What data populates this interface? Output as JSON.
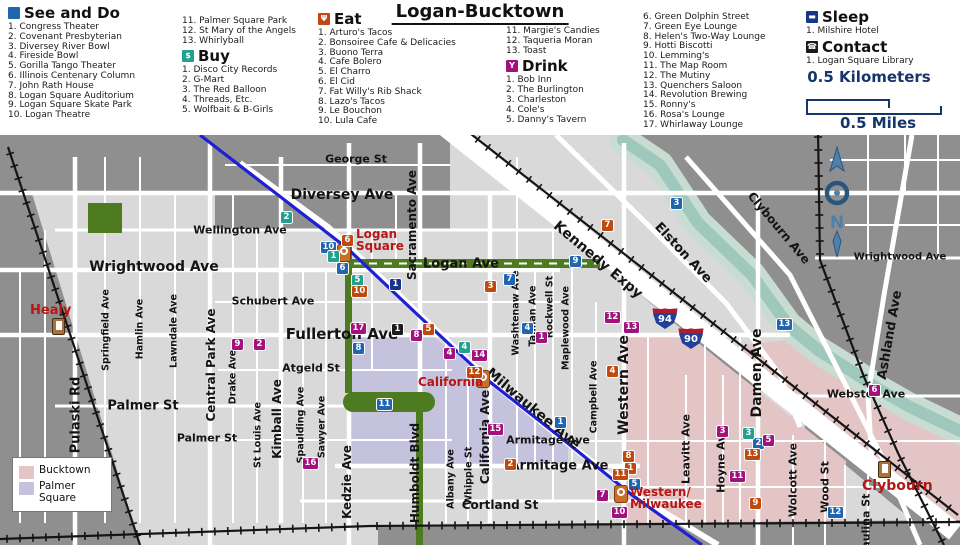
{
  "title": "Logan-Bucktown",
  "categories": {
    "see_do": {
      "label": "See and Do",
      "color": "#2065b1",
      "glyph": "",
      "items": [
        "Congress Theater",
        "Covenant Presbyterian",
        "Diversey River Bowl",
        "Fireside Bowl",
        "Gorilla Tango Theater",
        "Illinois Centenary Column",
        "John Rath House",
        "Logan Square Auditorium",
        "Logan Square Skate Park",
        "Logan Theatre",
        "Palmer Square Park",
        "St Mary of the Angels",
        "Whirlyball"
      ]
    },
    "buy": {
      "label": "Buy",
      "color": "#23a18e",
      "glyph": "$",
      "items": [
        "Disco City Records",
        "G-Mart",
        "The Red Balloon",
        "Threads, Etc.",
        "Wolfbait & B-Girls"
      ]
    },
    "eat": {
      "label": "Eat",
      "color": "#bf4a10",
      "glyph": "Ψ",
      "items": [
        "Arturo's Tacos",
        "Bonsoiree Cafe & Delicacies",
        "Buono Terra",
        "Cafe Bolero",
        "El Charro",
        "El Cid",
        "Fat Willy's Rib Shack",
        "Lazo's Tacos",
        "Le Bouchon",
        "Lula Cafe",
        "Margie's Candies",
        "Taqueria Moran",
        "Toast"
      ]
    },
    "drink": {
      "label": "Drink",
      "color": "#a2117e",
      "glyph": "Y",
      "items": [
        "Bob Inn",
        "The Burlington",
        "Charleston",
        "Cole's",
        "Danny's Tavern",
        "Green Dolphin Street",
        "Green Eye Lounge",
        "Helen's Two-Way Lounge",
        "Hotti Biscotti",
        "Lemming's",
        "The Map Room",
        "The Mutiny",
        "Quenchers Saloon",
        "Revolution Brewing",
        "Ronny's",
        "Rosa's Lounge",
        "Whirlaway Lounge"
      ]
    },
    "sleep": {
      "label": "Sleep",
      "color": "#16368c",
      "glyph": "▬",
      "items": [
        "Milshire Hotel"
      ]
    },
    "contact": {
      "label": "Contact",
      "color": "#1c1c1c",
      "glyph": "☎",
      "items": [
        "Logan Square Library"
      ]
    }
  },
  "scale": {
    "km": "0.5 Kilometers",
    "miles": "0.5 Miles"
  },
  "compass": {
    "letter": "N"
  },
  "map": {
    "regions": [
      {
        "label": "Bucktown",
        "color": "#e3c5c5"
      },
      {
        "label": "Palmer Square",
        "color": "#c4c2dd"
      }
    ],
    "streets": [
      {
        "t": "George St",
        "x": 356,
        "y": 24,
        "s": 11
      },
      {
        "t": "Diversey Ave",
        "x": 342,
        "y": 60,
        "s": 14
      },
      {
        "t": "Wellington Ave",
        "x": 240,
        "y": 95,
        "s": 11
      },
      {
        "t": "Wrightwood Ave",
        "x": 154,
        "y": 132,
        "s": 14
      },
      {
        "t": "Wrightwood Ave",
        "x": 900,
        "y": 122,
        "s": 10
      },
      {
        "t": "Schubert Ave",
        "x": 273,
        "y": 166,
        "s": 11
      },
      {
        "t": "Fullerton Ave",
        "x": 342,
        "y": 199,
        "s": 15
      },
      {
        "t": "Logan Ave",
        "x": 461,
        "y": 129,
        "s": 13
      },
      {
        "t": "Atgeld St",
        "x": 311,
        "y": 233,
        "s": 11
      },
      {
        "t": "Palmer St",
        "x": 143,
        "y": 271,
        "s": 13
      },
      {
        "t": "Palmer St",
        "x": 207,
        "y": 303,
        "s": 11
      },
      {
        "t": "Armitage Ave",
        "x": 559,
        "y": 331,
        "s": 13
      },
      {
        "t": "Armitage Ave",
        "x": 548,
        "y": 305,
        "s": 11
      },
      {
        "t": "Cortland St",
        "x": 500,
        "y": 370,
        "s": 12
      },
      {
        "t": "Webster Ave",
        "x": 866,
        "y": 259,
        "s": 11
      },
      {
        "t": "Pulaski Rd",
        "x": 76,
        "y": 280,
        "s": 13,
        "r": -90
      },
      {
        "t": "Springfield Ave",
        "x": 106,
        "y": 195,
        "s": 9.5,
        "r": -90
      },
      {
        "t": "Hamlin Ave",
        "x": 140,
        "y": 194,
        "s": 9.5,
        "r": -90
      },
      {
        "t": "Lawndale Ave",
        "x": 174,
        "y": 196,
        "s": 9.5,
        "r": -90
      },
      {
        "t": "Central Park Ave",
        "x": 211,
        "y": 230,
        "s": 12,
        "r": -90
      },
      {
        "t": "Drake Ave",
        "x": 233,
        "y": 242,
        "s": 9.5,
        "r": -90
      },
      {
        "t": "St Louis Ave",
        "x": 258,
        "y": 300,
        "s": 9.5,
        "r": -90
      },
      {
        "t": "Kimball Ave",
        "x": 277,
        "y": 284,
        "s": 12,
        "r": -90
      },
      {
        "t": "Spaulding Ave",
        "x": 301,
        "y": 290,
        "s": 9.5,
        "r": -90
      },
      {
        "t": "Sawyer Ave",
        "x": 322,
        "y": 292,
        "s": 9.5,
        "r": -90
      },
      {
        "t": "Kedzie Ave",
        "x": 347,
        "y": 347,
        "s": 12,
        "r": -90
      },
      {
        "t": "Sacramento Ave",
        "x": 412,
        "y": 90,
        "s": 12,
        "r": -90
      },
      {
        "t": "Humboldt Blvd",
        "x": 415,
        "y": 338,
        "s": 12,
        "r": -90
      },
      {
        "t": "Albany Ave",
        "x": 451,
        "y": 344,
        "s": 9.5,
        "r": -90
      },
      {
        "t": "Whipple St",
        "x": 469,
        "y": 341,
        "s": 9.5,
        "r": -90
      },
      {
        "t": "California Ave",
        "x": 485,
        "y": 302,
        "s": 12,
        "r": -90
      },
      {
        "t": "Washtenaw Ave",
        "x": 516,
        "y": 178,
        "s": 9.5,
        "r": -90
      },
      {
        "t": "Talman Ave",
        "x": 533,
        "y": 181,
        "s": 9.5,
        "r": -90
      },
      {
        "t": "Rockwell St",
        "x": 550,
        "y": 172,
        "s": 9.5,
        "r": -90
      },
      {
        "t": "Maplewood Ave",
        "x": 566,
        "y": 193,
        "s": 9.5,
        "r": -90
      },
      {
        "t": "Campbell Ave",
        "x": 594,
        "y": 262,
        "s": 9.5,
        "r": -90
      },
      {
        "t": "Western Ave",
        "x": 624,
        "y": 250,
        "s": 14,
        "r": -90
      },
      {
        "t": "Leavitt Ave",
        "x": 686,
        "y": 314,
        "s": 11,
        "r": -90
      },
      {
        "t": "Hoyne Ave",
        "x": 721,
        "y": 325,
        "s": 11,
        "r": -90
      },
      {
        "t": "Damen Ave",
        "x": 757,
        "y": 238,
        "s": 14,
        "r": -90
      },
      {
        "t": "Wolcott Ave",
        "x": 793,
        "y": 345,
        "s": 11,
        "r": -90
      },
      {
        "t": "Wood St",
        "x": 825,
        "y": 352,
        "s": 11,
        "r": -90
      },
      {
        "t": "Paulina St",
        "x": 866,
        "y": 390,
        "s": 11,
        "r": -90
      },
      {
        "t": "Ashland Ave",
        "x": 890,
        "y": 200,
        "s": 13,
        "r": -80
      },
      {
        "t": "Kennedy Expy",
        "x": 598,
        "y": 125,
        "s": 14,
        "r": 40
      },
      {
        "t": "Milwaukee Ave",
        "x": 533,
        "y": 274,
        "s": 14,
        "r": 40
      },
      {
        "t": "Elston Ave",
        "x": 683,
        "y": 118,
        "s": 13,
        "r": 47
      },
      {
        "t": "Clybourn Ave",
        "x": 779,
        "y": 93,
        "s": 12,
        "r": 50
      }
    ],
    "stations": [
      {
        "id": "healy",
        "type": "metra",
        "lines": [
          "Healy"
        ],
        "ix": 52,
        "iy": 183,
        "lx": 30,
        "ly": 169,
        "ls": 13
      },
      {
        "id": "logan-square",
        "type": "cta",
        "lines": [
          "Logan",
          "Square"
        ],
        "ix": 337,
        "iy": 109,
        "lx": 356,
        "ly": 93,
        "ls": 12
      },
      {
        "id": "california",
        "type": "cta",
        "lines": [
          "California"
        ],
        "ix": 476,
        "iy": 235,
        "lx": 418,
        "ly": 241,
        "ls": 12
      },
      {
        "id": "western-milwaukee",
        "type": "cta",
        "lines": [
          "Western/",
          "Milwaukee"
        ],
        "ix": 614,
        "iy": 350,
        "lx": 630,
        "ly": 351,
        "ls": 12
      },
      {
        "id": "clybourn",
        "type": "metra",
        "lines": [
          "Clybourn"
        ],
        "ix": 878,
        "iy": 326,
        "lx": 862,
        "ly": 344,
        "ls": 14
      }
    ],
    "badges": [
      {
        "c": "see_do",
        "n": 1,
        "x": 554,
        "y": 281
      },
      {
        "c": "see_do",
        "n": 2,
        "x": 752,
        "y": 302
      },
      {
        "c": "see_do",
        "n": 3,
        "x": 670,
        "y": 62
      },
      {
        "c": "see_do",
        "n": 4,
        "x": 521,
        "y": 187
      },
      {
        "c": "see_do",
        "n": 5,
        "x": 628,
        "y": 343
      },
      {
        "c": "see_do",
        "n": 6,
        "x": 336,
        "y": 127
      },
      {
        "c": "see_do",
        "n": 7,
        "x": 503,
        "y": 138
      },
      {
        "c": "see_do",
        "n": 8,
        "x": 352,
        "y": 207
      },
      {
        "c": "see_do",
        "n": 9,
        "x": 569,
        "y": 120
      },
      {
        "c": "see_do",
        "n": 10,
        "x": 320,
        "y": 106
      },
      {
        "c": "see_do",
        "n": 11,
        "x": 376,
        "y": 263
      },
      {
        "c": "see_do",
        "n": 12,
        "x": 827,
        "y": 371
      },
      {
        "c": "see_do",
        "n": 13,
        "x": 776,
        "y": 183
      },
      {
        "c": "buy",
        "n": 1,
        "x": 327,
        "y": 115
      },
      {
        "c": "buy",
        "n": 2,
        "x": 280,
        "y": 76
      },
      {
        "c": "buy",
        "n": 3,
        "x": 742,
        "y": 292
      },
      {
        "c": "buy",
        "n": 4,
        "x": 458,
        "y": 206
      },
      {
        "c": "buy",
        "n": 5,
        "x": 351,
        "y": 139
      },
      {
        "c": "eat",
        "n": 1,
        "x": 624,
        "y": 327
      },
      {
        "c": "eat",
        "n": 2,
        "x": 504,
        "y": 323
      },
      {
        "c": "eat",
        "n": 3,
        "x": 484,
        "y": 145
      },
      {
        "c": "eat",
        "n": 4,
        "x": 606,
        "y": 230
      },
      {
        "c": "eat",
        "n": 5,
        "x": 422,
        "y": 188
      },
      {
        "c": "eat",
        "n": 6,
        "x": 341,
        "y": 99
      },
      {
        "c": "eat",
        "n": 7,
        "x": 601,
        "y": 84
      },
      {
        "c": "eat",
        "n": 8,
        "x": 622,
        "y": 315
      },
      {
        "c": "eat",
        "n": 9,
        "x": 749,
        "y": 362
      },
      {
        "c": "eat",
        "n": 10,
        "x": 351,
        "y": 150
      },
      {
        "c": "eat",
        "n": 11,
        "x": 612,
        "y": 333
      },
      {
        "c": "eat",
        "n": 12,
        "x": 466,
        "y": 231
      },
      {
        "c": "eat",
        "n": 13,
        "x": 744,
        "y": 313
      },
      {
        "c": "drink",
        "n": 1,
        "x": 535,
        "y": 196
      },
      {
        "c": "drink",
        "n": 2,
        "x": 253,
        "y": 203
      },
      {
        "c": "drink",
        "n": 3,
        "x": 716,
        "y": 290
      },
      {
        "c": "drink",
        "n": 4,
        "x": 443,
        "y": 212
      },
      {
        "c": "drink",
        "n": 5,
        "x": 762,
        "y": 299
      },
      {
        "c": "drink",
        "n": 6,
        "x": 868,
        "y": 249
      },
      {
        "c": "drink",
        "n": 7,
        "x": 596,
        "y": 354
      },
      {
        "c": "drink",
        "n": 8,
        "x": 410,
        "y": 194
      },
      {
        "c": "drink",
        "n": 9,
        "x": 231,
        "y": 203
      },
      {
        "c": "drink",
        "n": 10,
        "x": 611,
        "y": 371
      },
      {
        "c": "drink",
        "n": 11,
        "x": 729,
        "y": 335
      },
      {
        "c": "drink",
        "n": 12,
        "x": 604,
        "y": 176
      },
      {
        "c": "drink",
        "n": 13,
        "x": 623,
        "y": 186
      },
      {
        "c": "drink",
        "n": 14,
        "x": 471,
        "y": 214
      },
      {
        "c": "drink",
        "n": 15,
        "x": 487,
        "y": 288
      },
      {
        "c": "drink",
        "n": 16,
        "x": 302,
        "y": 322
      },
      {
        "c": "drink",
        "n": 17,
        "x": 350,
        "y": 187
      },
      {
        "c": "sleep",
        "n": 1,
        "x": 389,
        "y": 143
      },
      {
        "c": "contact",
        "n": 1,
        "x": 391,
        "y": 188
      }
    ],
    "shields": [
      {
        "label": "94",
        "x": 652,
        "y": 173
      },
      {
        "label": "90",
        "x": 678,
        "y": 193
      }
    ]
  }
}
